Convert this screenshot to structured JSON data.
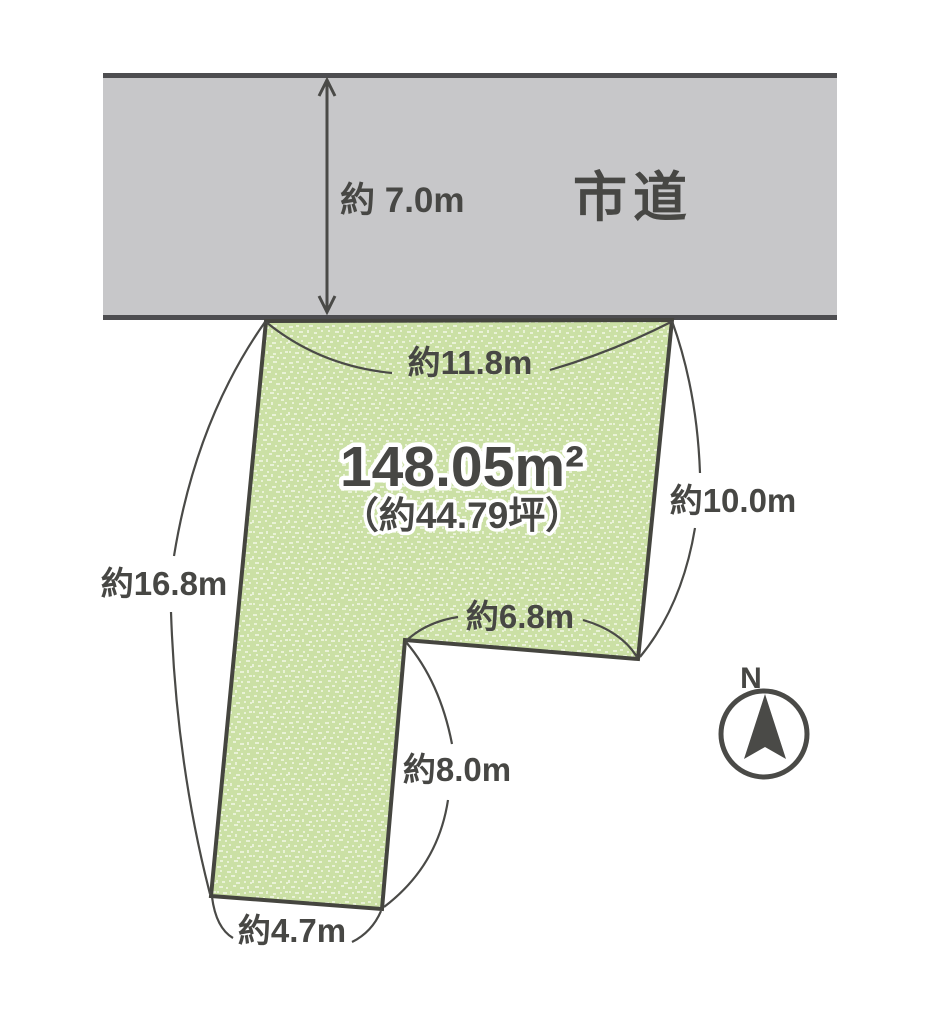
{
  "road": {
    "name_label": "市道",
    "width_label": "約 7.0m"
  },
  "plot": {
    "area_sqm": "148.05m²",
    "area_tsubo": "（約44.79坪）",
    "edge_top": "約11.8m",
    "edge_right": "約10.0m",
    "edge_left": "約16.8m",
    "edge_notch": "約6.8m",
    "edge_leg_right": "約8.0m",
    "edge_bottom": "約4.7m"
  },
  "compass": {
    "north_label": "N"
  },
  "colors": {
    "background": "#ffffff",
    "road_fill": "#c7c7c9",
    "road_border": "#4d4d50",
    "plot_fill": "#cbe0a5",
    "plot_speckle": "#e9f2d7",
    "plot_border": "#45453f",
    "line": "#4a4a47",
    "text": "#474744"
  }
}
